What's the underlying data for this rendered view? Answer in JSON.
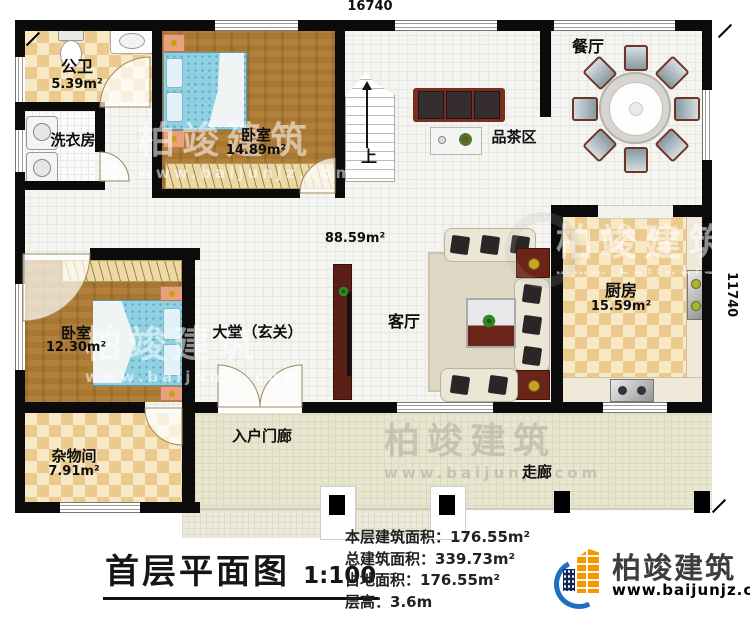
{
  "dimensions": {
    "width_label": "16740",
    "height_label": "11740"
  },
  "rooms": {
    "public_bath": {
      "name": "公卫",
      "area": "5.39m²"
    },
    "laundry": {
      "name": "洗衣房"
    },
    "bedroom1": {
      "name": "卧室",
      "area": "14.89m²"
    },
    "dining": {
      "name": "餐厅"
    },
    "tea_area": {
      "name": "品茶区"
    },
    "stairs": {
      "up_label": "上"
    },
    "hall_area": {
      "area": "88.59m²"
    },
    "lobby": {
      "name": "大堂（玄关）"
    },
    "living": {
      "name": "客厅"
    },
    "kitchen": {
      "name": "厨房",
      "area": "15.59m²"
    },
    "bedroom2": {
      "name": "卧室",
      "area": "12.30m²"
    },
    "storage": {
      "name": "杂物间",
      "area": "7.91m²"
    },
    "entry_porch": {
      "name": "入户门廊"
    },
    "corridor": {
      "name": "走廊"
    }
  },
  "title_block": {
    "title": "首层平面图",
    "scale": "1:100",
    "stats": [
      {
        "label": "本层建筑面积：",
        "value": "176.55m²"
      },
      {
        "label": "总建筑面积：",
        "value": "339.73m²"
      },
      {
        "label": "占地面积：",
        "value": "176.55m²"
      },
      {
        "label": "层高：",
        "value": "3.6m"
      }
    ]
  },
  "brand": {
    "name": "柏竣建筑",
    "url": "www.baijunjz.com"
  },
  "watermark": {
    "name": "柏竣建筑",
    "url": "www.baijunjz.com"
  },
  "colors": {
    "wall": "#0b0b0b",
    "checker": "#ecca8e",
    "wood": "#a87732",
    "bed_blue": "#8fd0e2",
    "brand_blue": "#1f6fc0",
    "brand_orange": "#f49a00"
  }
}
